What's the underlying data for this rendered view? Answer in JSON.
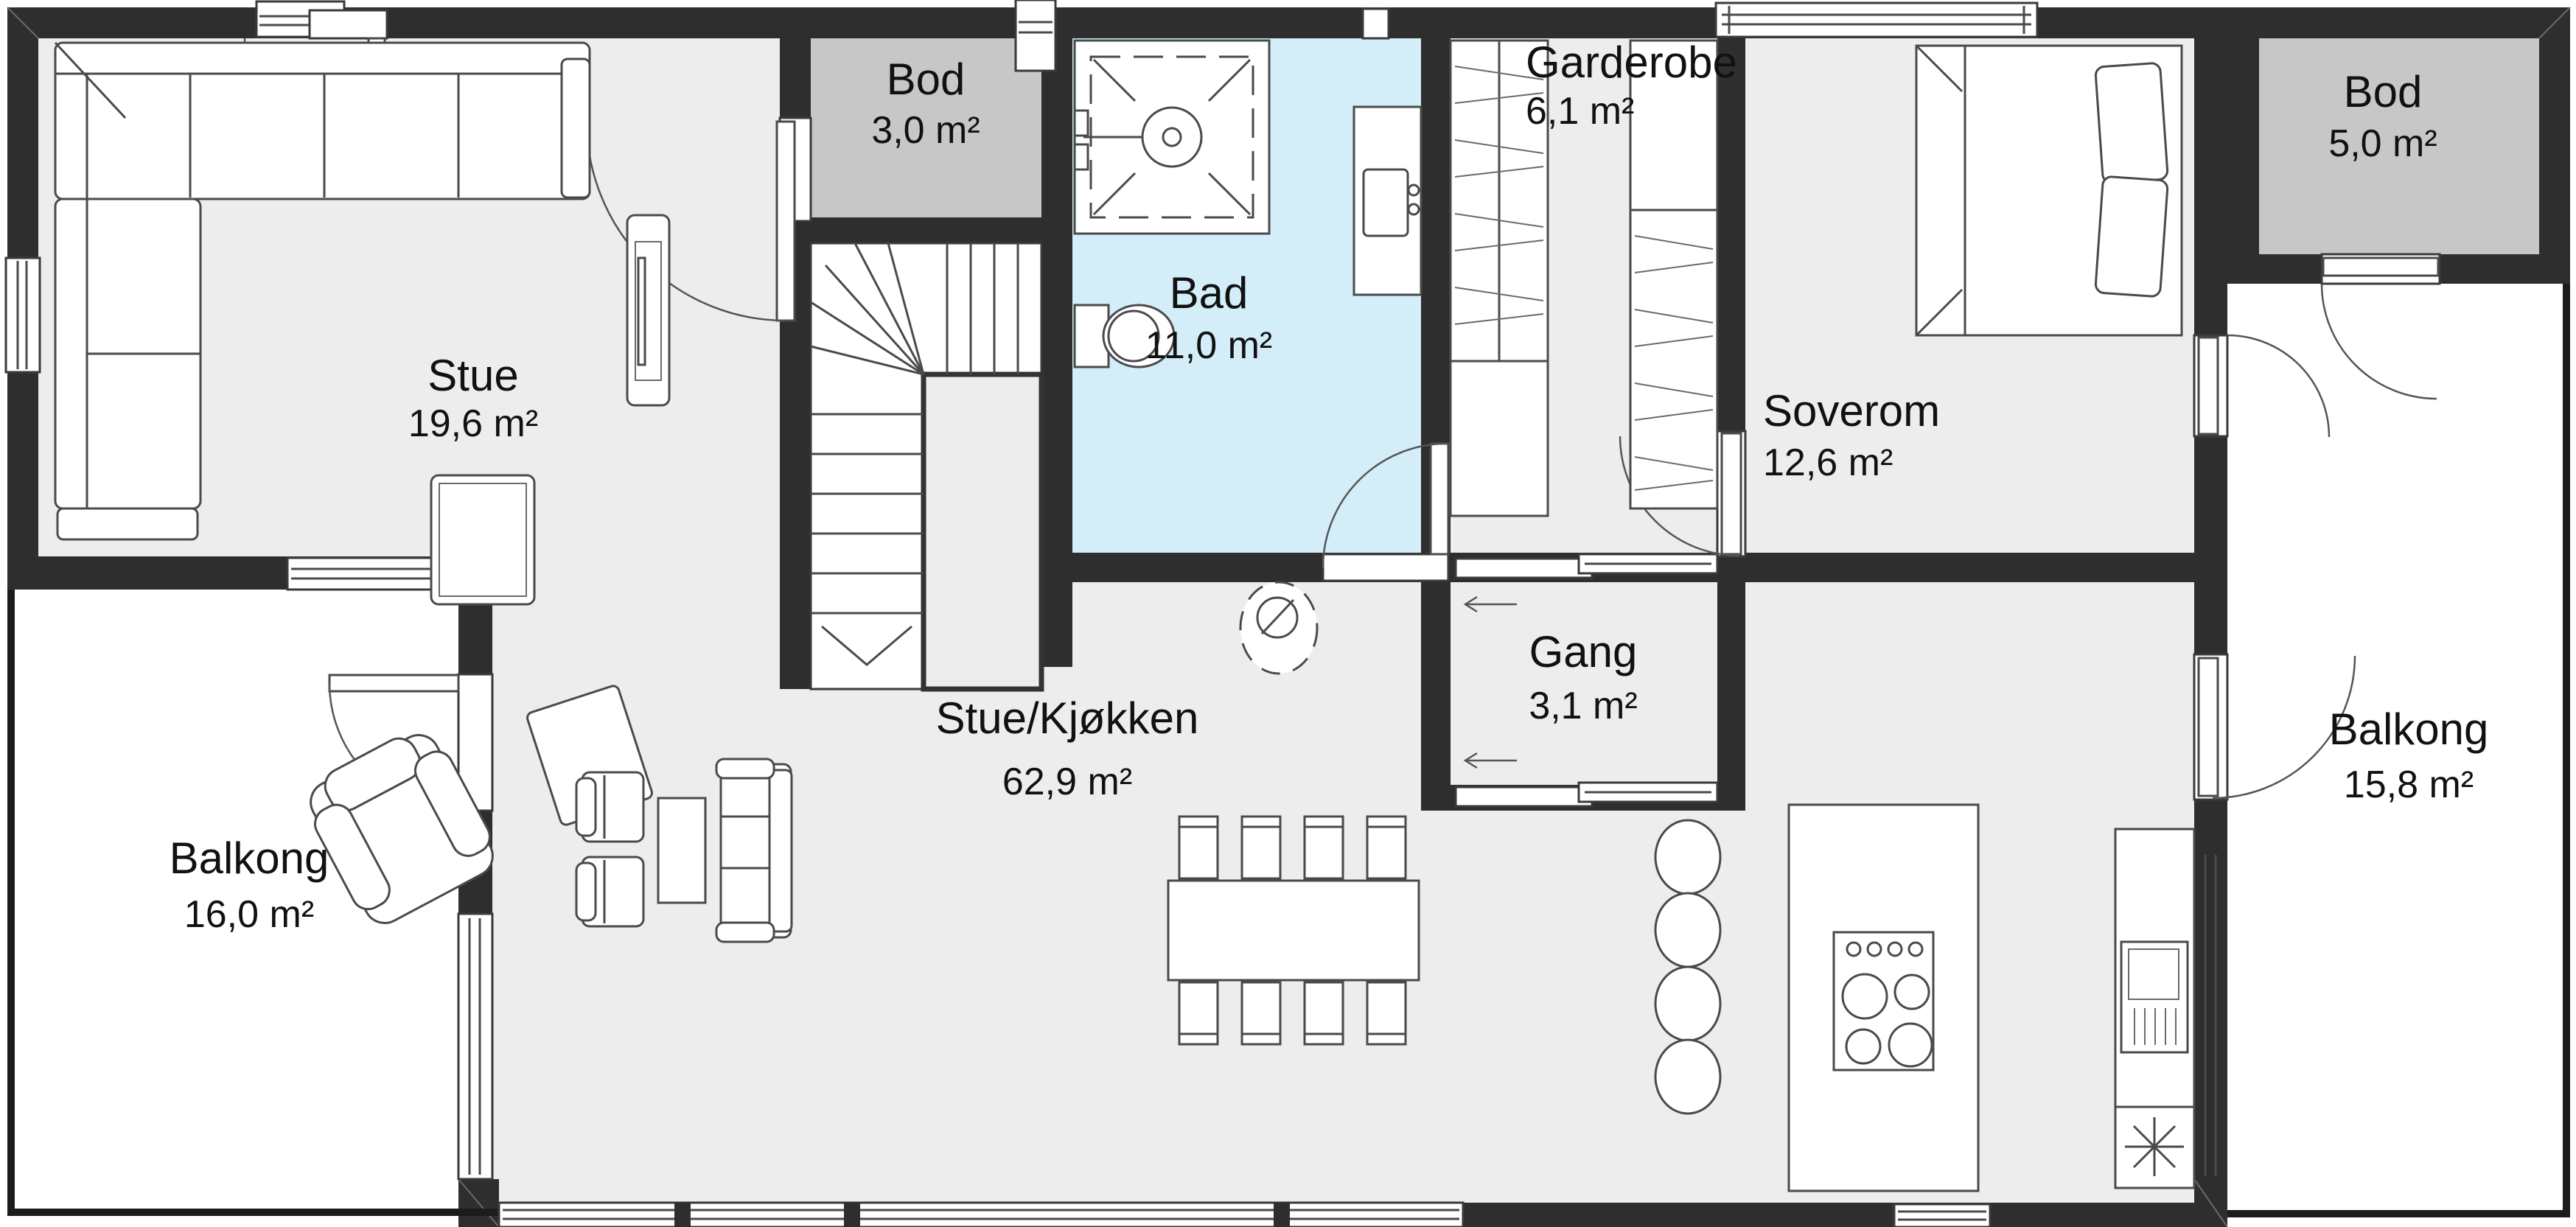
{
  "plan": {
    "type": "floorplan",
    "colors": {
      "wall": "#2e2e2e",
      "floor": "#ededed",
      "bathroom_fill": "#d3eef9",
      "storage_fill": "#c7c7c7",
      "balcony_fill": "#ffffff"
    },
    "rooms": [
      {
        "name": "Stue",
        "area": "19,6 m²"
      },
      {
        "name": "Bod",
        "area": "3,0 m²"
      },
      {
        "name": "Bad",
        "area": "11,0 m²"
      },
      {
        "name": "Garderobe",
        "area": "6,1 m²"
      },
      {
        "name": "Gang",
        "area": "3,1 m²"
      },
      {
        "name": "Soverom",
        "area": "12,6 m²"
      },
      {
        "name": "Bod",
        "area": "5,0 m²"
      },
      {
        "name": "Stue/Kjøkken",
        "area": "62,9 m²"
      },
      {
        "name": "Balkong",
        "area": "16,0 m²"
      },
      {
        "name": "Balkong",
        "area": "15,8 m²"
      }
    ]
  }
}
